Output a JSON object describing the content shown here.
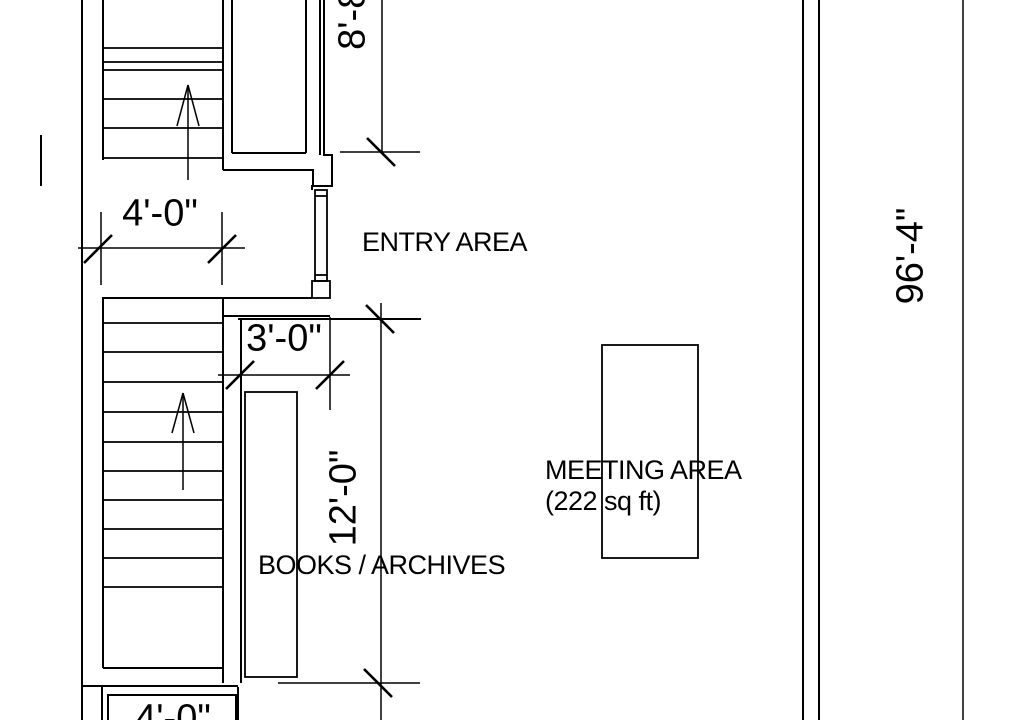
{
  "drawing": {
    "background": "#ffffff",
    "line_color": "#000000",
    "labels": {
      "entry": "ENTRY AREA",
      "meeting": "MEETING AREA",
      "meeting_sqft": "(222 sq ft)",
      "books": "BOOKS / ARCHIVES"
    },
    "dimensions": {
      "stair_width": "4'-0\"",
      "door_clearance": "3'-0\"",
      "books_run": "12'-0\"",
      "upper_segment": "8'-8\"",
      "overall_height": "96'-4\"",
      "lower_box": "4'-0\""
    }
  }
}
